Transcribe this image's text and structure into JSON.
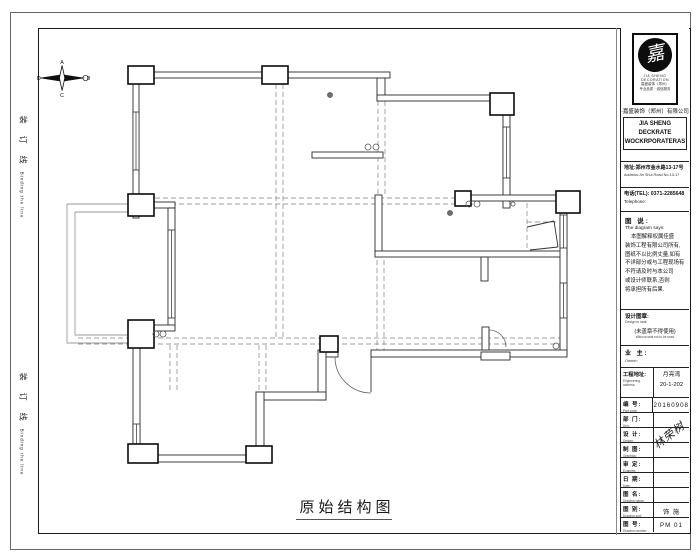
{
  "sheet": {
    "plan_title": "原始结构图",
    "binding_text": "装 订 线",
    "binding_text_en": "Binding the line"
  },
  "compass": {
    "top": "A",
    "right": "B",
    "bottom": "C",
    "left": "D"
  },
  "title_block": {
    "logo_glyph": "嘉",
    "logo_caption1": "JIA SHENG DECORATION",
    "logo_caption2": "嘉盛装饰（郑州）",
    "logo_caption3": "专业品质 · 诚信服务",
    "company_cn": "·嘉盛装饰（郑州）有限公司",
    "company_en1": "JIA SHENG DECKRATE",
    "company_en2": "WOCKRPORATERAS",
    "address_cn": "地址:郑州市金水路13-17号",
    "address_en": "Address:Jin Shui Road No.13-17",
    "phone_cn": "电话(TEL): 0371-2285648",
    "phone_en": "Telephone:",
    "notes_title": "图 说:",
    "notes_subtitle": "The diagram says:",
    "notes_lines": [
      "本图解释权属佳盛",
      "装饰工程有限公司所有,",
      "图纸不以比例丈量,如有",
      "不详部分或与工程现场有",
      "不符请及时与本公司",
      "或设计师联系,否则",
      "将承担所有后果."
    ],
    "seal_label": "设计图章:",
    "seal_label_en": "Design in seal:",
    "seal_warning": "(未盖章不得使用)",
    "seal_warning_en": "Without seal not to be used",
    "owner_label": "业 主:",
    "owner_label_en": "Owner:",
    "project_label": "工程地址:",
    "project_label_en": "Engineering address:",
    "project_value1": "月亮湾",
    "project_value2": "20-1-202",
    "signature": "林荣树",
    "rows": [
      {
        "cn": "编 号:",
        "en": "Part code:",
        "value": "20160908"
      },
      {
        "cn": "部 门:",
        "en": "Dep:",
        "value": ""
      },
      {
        "cn": "设 计:",
        "en": "Design:",
        "value": ""
      },
      {
        "cn": "制 图:",
        "en": "Graphics:",
        "value": ""
      },
      {
        "cn": "审 定:",
        "en": "Examine:",
        "value": ""
      },
      {
        "cn": "日 期:",
        "en": "Date:",
        "value": ""
      },
      {
        "cn": "图 名:",
        "en": "Drawing name:",
        "value": ""
      },
      {
        "cn": "图 别:",
        "en": "Drawing sort:",
        "value": "饰 施"
      },
      {
        "cn": "图 号:",
        "en": "Drawing number:",
        "value": "PM 01"
      }
    ]
  },
  "plan": {
    "walls": [
      [
        133,
        72,
        257,
        6
      ],
      [
        377,
        78,
        8,
        23
      ],
      [
        377,
        95,
        133,
        6
      ],
      [
        312,
        152,
        71,
        6
      ],
      [
        503,
        101,
        7,
        107
      ],
      [
        462,
        195,
        115,
        6
      ],
      [
        375,
        195,
        7,
        62
      ],
      [
        375,
        251,
        192,
        6
      ],
      [
        481,
        257,
        7,
        24
      ],
      [
        560,
        201,
        7,
        154
      ],
      [
        326,
        350,
        12,
        7
      ],
      [
        371,
        350,
        196,
        7
      ],
      [
        482,
        327,
        7,
        23
      ],
      [
        481,
        352,
        29,
        8
      ],
      [
        318,
        350,
        8,
        50
      ],
      [
        256,
        392,
        70,
        8
      ],
      [
        256,
        392,
        8,
        70
      ],
      [
        133,
        455,
        137,
        7
      ],
      [
        133,
        72,
        6,
        146
      ],
      [
        152,
        202,
        23,
        6
      ],
      [
        168,
        208,
        7,
        120
      ],
      [
        133,
        325,
        42,
        6
      ],
      [
        133,
        331,
        7,
        127
      ]
    ],
    "columns": [
      [
        128,
        66,
        26,
        18
      ],
      [
        262,
        66,
        26,
        18
      ],
      [
        490,
        93,
        24,
        22
      ],
      [
        556,
        191,
        24,
        22
      ],
      [
        128,
        194,
        26,
        22
      ],
      [
        128,
        320,
        26,
        28
      ],
      [
        128,
        444,
        30,
        19
      ],
      [
        246,
        446,
        26,
        17
      ],
      [
        320,
        336,
        18,
        16
      ],
      [
        455,
        191,
        16,
        15
      ]
    ],
    "windows": [
      [
        133,
        112,
        6,
        58
      ],
      [
        168,
        230,
        7,
        88
      ],
      [
        133,
        424,
        7,
        28
      ],
      [
        503,
        127,
        7,
        51
      ],
      [
        560,
        215,
        7,
        33
      ],
      [
        560,
        283,
        7,
        35
      ]
    ],
    "dashed": [
      [
        78,
        338,
        560,
        338
      ],
      [
        78,
        344,
        560,
        344
      ],
      [
        276,
        84,
        276,
        338
      ],
      [
        283,
        84,
        283,
        338
      ],
      [
        155,
        198,
        460,
        198
      ],
      [
        155,
        204,
        460,
        204
      ],
      [
        378,
        101,
        378,
        195
      ],
      [
        385,
        101,
        385,
        195
      ],
      [
        377,
        260,
        377,
        350
      ],
      [
        384,
        260,
        384,
        350
      ],
      [
        170,
        345,
        170,
        392
      ],
      [
        177,
        345,
        177,
        392
      ],
      [
        259,
        345,
        259,
        392
      ],
      [
        266,
        345,
        266,
        392
      ],
      [
        527,
        203,
        527,
        250
      ],
      [
        527,
        222,
        558,
        222
      ]
    ],
    "thin": [
      [
        152,
        204,
        67,
        204
      ],
      [
        67,
        204,
        67,
        343
      ],
      [
        67,
        343,
        152,
        343
      ],
      [
        152,
        212,
        75,
        212
      ],
      [
        75,
        212,
        75,
        335
      ],
      [
        75,
        335,
        152,
        335
      ]
    ],
    "lines": [
      [
        527,
        227,
        554,
        221
      ],
      [
        554,
        221,
        558,
        247
      ],
      [
        558,
        247,
        530,
        250
      ],
      [
        371,
        357,
        371,
        392
      ],
      [
        489,
        330,
        489,
        347
      ]
    ],
    "arcs": [
      "M335,357 A36,36 0 0 0 371,393",
      "M489,330 A17,17 0 0 1 506,347"
    ],
    "circles": [
      [
        368,
        147,
        3,
        0
      ],
      [
        376,
        147,
        3,
        0
      ],
      [
        156,
        334,
        3,
        0
      ],
      [
        163,
        334,
        3,
        0
      ],
      [
        469,
        204,
        3,
        0
      ],
      [
        477,
        204,
        3,
        0
      ],
      [
        513,
        204,
        2,
        0
      ],
      [
        556,
        346,
        3,
        0
      ],
      [
        330,
        95,
        2.5,
        1
      ],
      [
        450,
        213,
        2.5,
        1
      ]
    ]
  }
}
